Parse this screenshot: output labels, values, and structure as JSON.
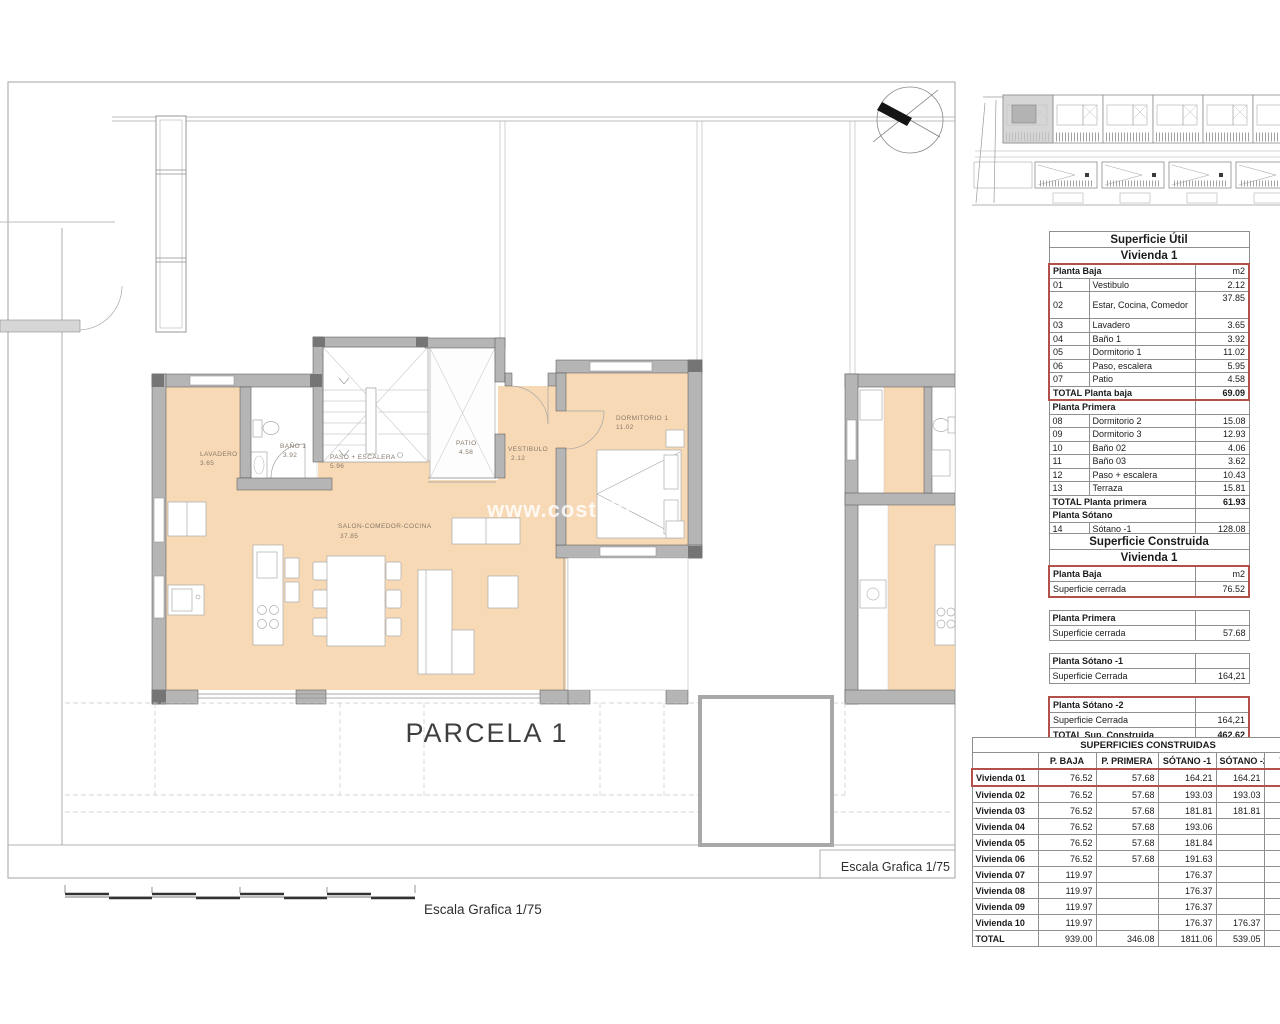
{
  "plan": {
    "parcel": "PARCELA 1",
    "scale": "Escala Grafica 1/75",
    "watermark_a": "www.costabl",
    "watermark_b": "si",
    "rooms": {
      "lavadero": {
        "name": "LAVADERO",
        "area": "3.65"
      },
      "bano": {
        "name": "BAÑO 1",
        "area": "3.92"
      },
      "paso": {
        "name": "PASO + ESCALERA",
        "area": "5.96"
      },
      "patio": {
        "name": "PATIO",
        "area": "4.58"
      },
      "vestibulo": {
        "name": "VESTIBULO",
        "area": "2.12"
      },
      "dormitorio": {
        "name": "DORMITORIO 1",
        "area": "11.02"
      },
      "salon": {
        "name": "SALON-COMEDOR-COCINA",
        "area": "37.85"
      }
    }
  },
  "colors": {
    "room_fill": "#f8d9b5",
    "wall": "#b5b5b5",
    "highlight": "#b2514a"
  },
  "tables": {
    "util": {
      "title": "Superficie Útil",
      "subtitle": "Vivienda 1",
      "rows": [
        {
          "t": "Planta Baja",
          "v": "m2"
        },
        {
          "n": "01",
          "t": "Vestibulo",
          "v": "2.12"
        },
        {
          "n": "02",
          "t": "Estar, Cocina, Comedor",
          "v": "37.85"
        },
        {
          "n": "03",
          "t": "Lavadero",
          "v": "3.65"
        },
        {
          "n": "04",
          "t": "Baño 1",
          "v": "3.92"
        },
        {
          "n": "05",
          "t": "Dormitorio 1",
          "v": "11.02"
        },
        {
          "n": "06",
          "t": "Paso, escalera",
          "v": "5.95"
        },
        {
          "n": "07",
          "t": "Patio",
          "v": "4.58"
        },
        {
          "t": "TOTAL Planta baja",
          "v": "69.09"
        },
        {
          "t": "Planta Primera",
          "v": ""
        },
        {
          "n": "08",
          "t": "Dormitorio 2",
          "v": "15.08"
        },
        {
          "n": "09",
          "t": "Dormitorio 3",
          "v": "12.93"
        },
        {
          "n": "10",
          "t": "Baño 02",
          "v": "4.06"
        },
        {
          "n": "11",
          "t": "Baño 03",
          "v": "3.62"
        },
        {
          "n": "12",
          "t": "Paso + escalera",
          "v": "10.43"
        },
        {
          "n": "13",
          "t": "Terraza",
          "v": "15.81"
        },
        {
          "t": "TOTAL Planta primera",
          "v": "61.93"
        },
        {
          "t": "Planta Sótano",
          "v": ""
        },
        {
          "n": "14",
          "t": "Sótano -1",
          "v": "128.08"
        },
        {
          "n": "15",
          "t": "Sótano -2",
          "v": "146.35"
        },
        {
          "t": "TOTAL",
          "v": "405.45"
        }
      ]
    },
    "construida": {
      "title": "Superficie Construida",
      "subtitle": "Vivienda 1",
      "rows": [
        {
          "t": "Planta Baja",
          "v": "m2"
        },
        {
          "t": "Superficie cerrada",
          "v": "76.52"
        },
        {
          "t": "Planta Primera",
          "v": ""
        },
        {
          "t": "Superficie cerrada",
          "v": "57.68"
        },
        {
          "t": "Planta Sótano -1",
          "v": ""
        },
        {
          "t": "Superficie Cerrada",
          "v": "164,21"
        },
        {
          "t": "Planta Sótano -2",
          "v": ""
        },
        {
          "t": "Superficie Cerrada",
          "v": "164,21"
        },
        {
          "t": "TOTAL Sup. Construida",
          "v": "462.62"
        }
      ]
    },
    "resumen": {
      "title": "SUPERFICIES CONSTRUIDAS",
      "headers": [
        "",
        "P. BAJA",
        "P. PRIMERA",
        "SÓTANO -1",
        "SÓTANO -2",
        "TOTAL"
      ],
      "rows": [
        [
          "Vivienda 01",
          "76.52",
          "57.68",
          "164.21",
          "164.21",
          ""
        ],
        [
          "Vivienda 02",
          "76.52",
          "57.68",
          "193.03",
          "193.03",
          ""
        ],
        [
          "Vivienda 03",
          "76.52",
          "57.68",
          "181.81",
          "181.81",
          ""
        ],
        [
          "Vivienda 04",
          "76.52",
          "57.68",
          "193.06",
          "",
          ""
        ],
        [
          "Vivienda 05",
          "76.52",
          "57.68",
          "181.84",
          "",
          ""
        ],
        [
          "Vivienda 06",
          "76.52",
          "57.68",
          "191.63",
          "",
          ""
        ],
        [
          "Vivienda 07",
          "119.97",
          "",
          "176.37",
          "",
          ""
        ],
        [
          "Vivienda 08",
          "119.97",
          "",
          "176.37",
          "",
          ""
        ],
        [
          "Vivienda 09",
          "119.97",
          "",
          "176.37",
          "",
          ""
        ],
        [
          "Vivienda 10",
          "119.97",
          "",
          "176.37",
          "176.37",
          ""
        ],
        [
          "TOTAL",
          "939.00",
          "346.08",
          "1811.06",
          "539.05",
          ""
        ]
      ]
    }
  }
}
